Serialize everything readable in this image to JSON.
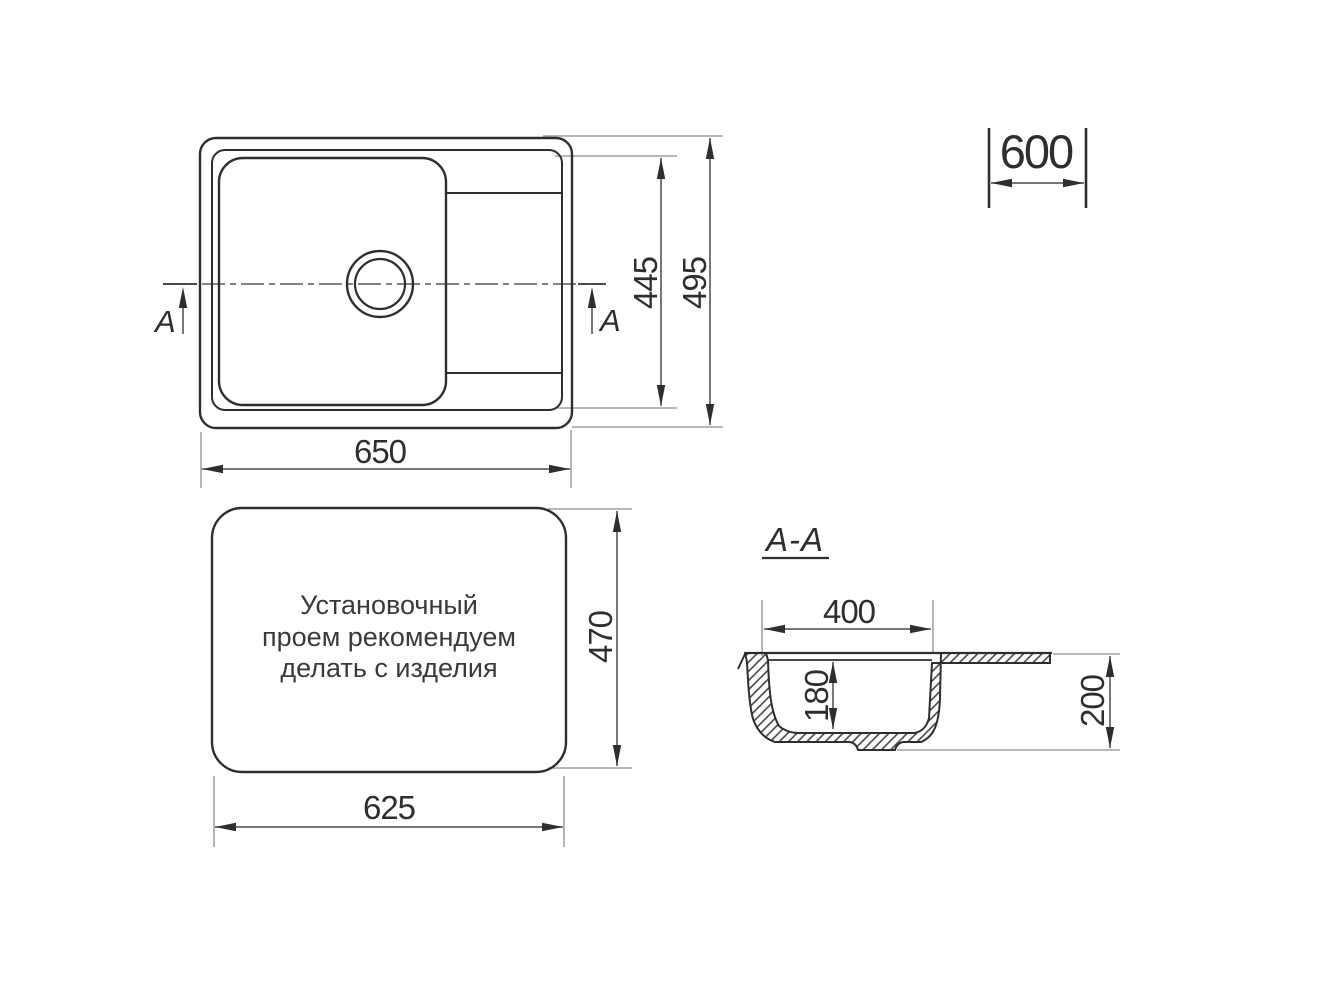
{
  "drawing": {
    "background": "#ffffff",
    "line_color": "#2e2e2e",
    "dim_color": "#4a4a4a",
    "ext_color": "#8d8d8d"
  },
  "top_view": {
    "section_arrow_left_label": "A",
    "section_arrow_right_label": "A",
    "dim_length": "650",
    "dim_bowl_span": "445",
    "dim_width": "495"
  },
  "cabinet": {
    "dim_min_base_width": "600"
  },
  "cutout_view": {
    "note_lines": [
      "Установочный",
      "проем рекомендуем",
      "делать с изделия"
    ],
    "dim_length": "625",
    "dim_width": "470"
  },
  "section_view": {
    "title": "A-A",
    "dim_bowl_top_width": "400",
    "dim_bowl_depth": "180",
    "dim_overall_height": "200"
  }
}
